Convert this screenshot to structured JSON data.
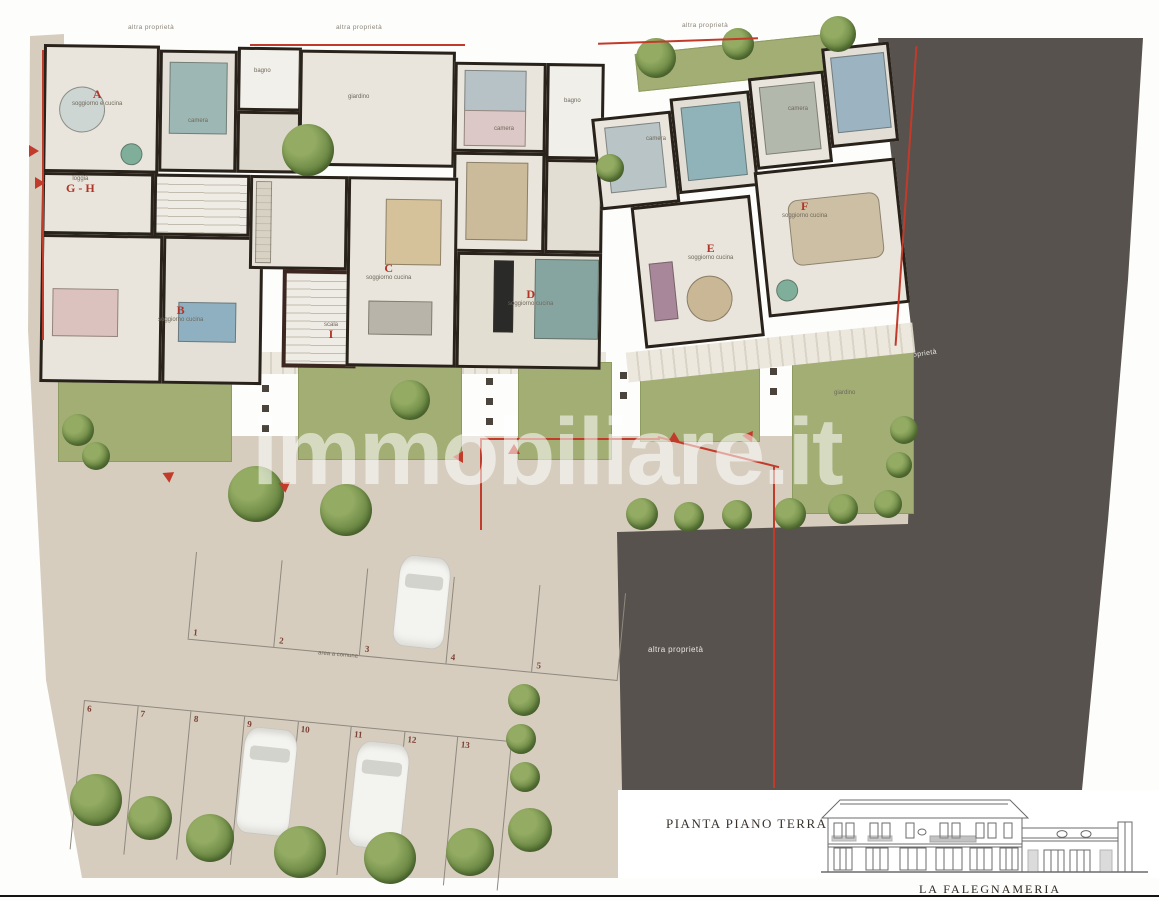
{
  "colors": {
    "accent_red": "#b03527",
    "dark_other_property": "#57524d",
    "lawn_green": "#a3ae75",
    "paving_beige": "#d6cdbf",
    "wall_black": "#28221b"
  },
  "boundary_labels": {
    "top_left": "altra proprietà",
    "top_mid": "altra proprietà",
    "top_right": "altra proprietà",
    "right_side": "altra proprietà",
    "center_dark": "altra proprietà"
  },
  "apartments": [
    {
      "letter": "A",
      "room": "soggiorno e cucina"
    },
    {
      "letter": "G - H",
      "room": "loggia"
    },
    {
      "letter": "B",
      "room": "soggiorno cucina"
    },
    {
      "letter": "C",
      "room": "soggiorno cucina"
    },
    {
      "letter": "D",
      "room": "soggiorno cucina"
    },
    {
      "letter": "E",
      "room": "soggiorno cucina"
    },
    {
      "letter": "F",
      "room": "soggiorno cucina"
    },
    {
      "letter": "I",
      "room": "scala"
    }
  ],
  "rooms": [
    {
      "t": "camera"
    },
    {
      "t": "camera"
    },
    {
      "t": "camera"
    },
    {
      "t": "camera"
    },
    {
      "t": "bagno"
    },
    {
      "t": "bagno"
    },
    {
      "t": "giardino"
    },
    {
      "t": "giardino"
    }
  ],
  "parking": {
    "spots": [
      "1",
      "2",
      "3",
      "4",
      "5",
      "6",
      "7",
      "8",
      "9",
      "10",
      "11",
      "12",
      "13"
    ],
    "road_label": "area a comune"
  },
  "watermark": "immobiliare.it",
  "legend": {
    "title": "PIANTA PIANO TERRA",
    "caption": "LA FALEGNAMERIA"
  }
}
